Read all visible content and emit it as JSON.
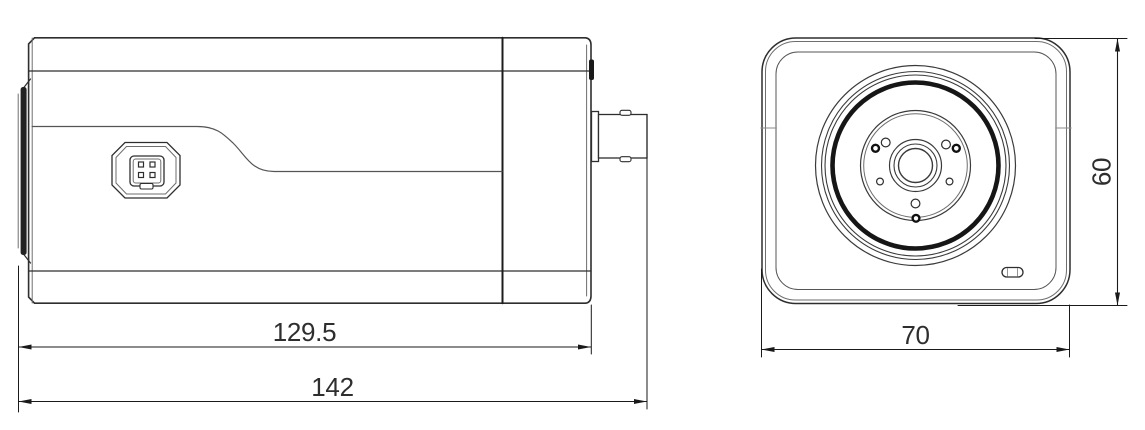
{
  "drawing": {
    "type": "technical-dimension-drawing",
    "subject": "box camera",
    "background": "#ffffff",
    "line_color": "#2e2e2e",
    "thin_line_color": "#707070",
    "dim_line_color": "#1a1a1a",
    "dimensions": {
      "body_length": "129.5",
      "total_length": "142",
      "front_width": "70",
      "front_height": "60"
    }
  }
}
